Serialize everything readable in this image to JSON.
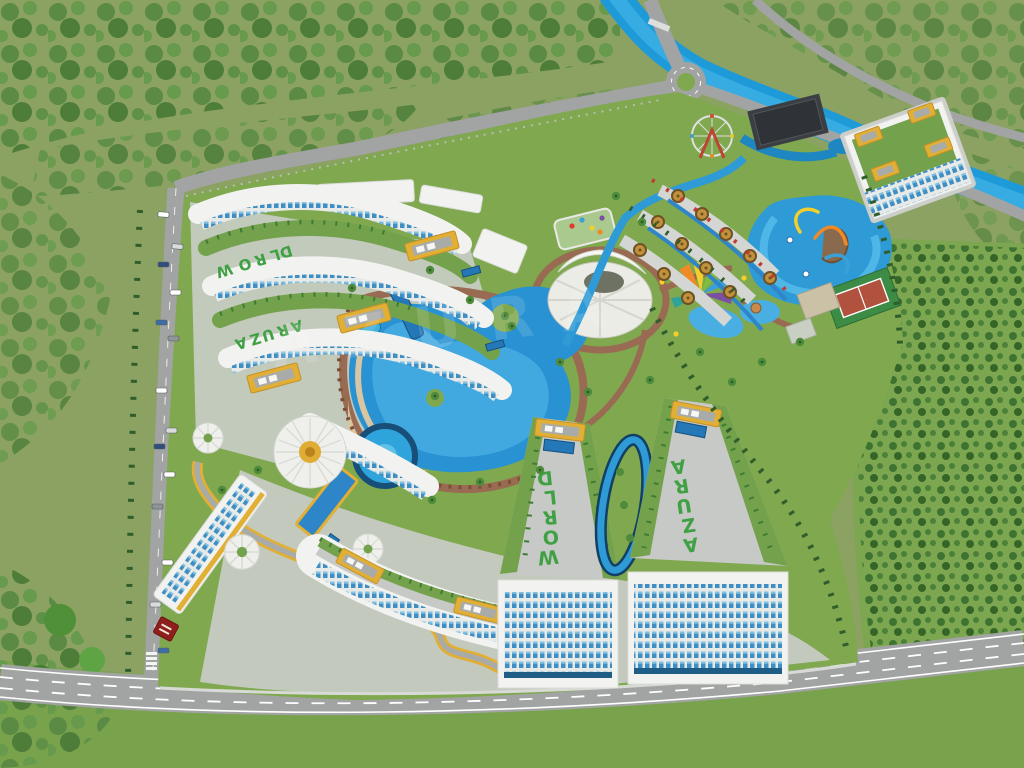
{
  "scene": {
    "watermark": "AZURA"
  },
  "labels": {
    "nw_upper": "WORLD",
    "nw_lower": "AZURA",
    "south_center": "WORLD",
    "south_east": "AZURA"
  },
  "colors": {
    "field": "#8BA263",
    "grass": "#79A24D",
    "lawn": "#7FA84F",
    "roofLawn": "#74A24C",
    "river": "#1E9AD8",
    "riverLight": "#45B5E8",
    "road": "#A2A4A3",
    "hardscape": "#C9CCC7",
    "path": "#9A6B53",
    "sand": "#D8C6A2",
    "pool": "#2892D2",
    "poolLight": "#49AFE3",
    "poolDark": "#174F78",
    "building": "#F2F3F0",
    "gold": "#E2AF35",
    "roofText": "#3FA044",
    "darkBuilding": "#3B3F43",
    "clay": "#B0523E",
    "courtGreen": "#3C8C46",
    "cabana": "#C2913C",
    "sign": "#8E1F1C"
  }
}
